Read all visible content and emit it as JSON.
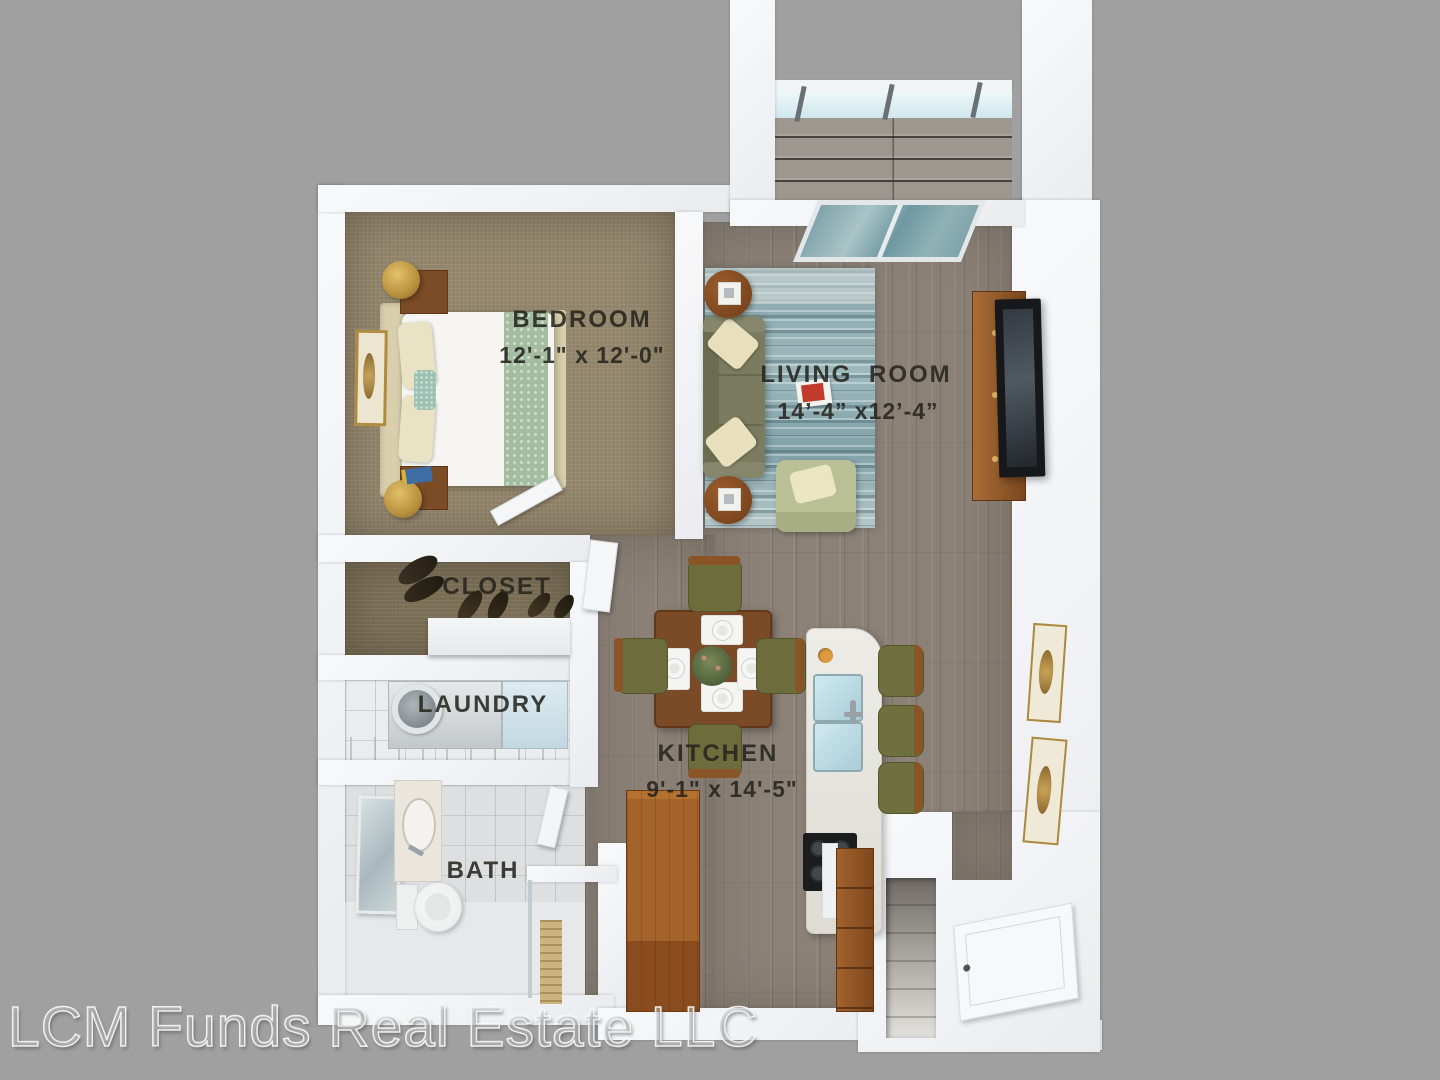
{
  "watermark": "LCM Funds Real Estate LLC",
  "rooms": {
    "bedroom": {
      "label": "BEDROOM",
      "dims": "12'-1\" x 12'-0\""
    },
    "living": {
      "label": "LIVING ROOM",
      "dims": "14’-4” x12’-4”"
    },
    "closet": {
      "label": "CLOSET"
    },
    "laundry": {
      "label": "LAUNDRY"
    },
    "kitchen": {
      "label": "KITCHEN",
      "dims": "9'-1\" x 14'-5\""
    },
    "bath": {
      "label": "BATH"
    }
  },
  "colors": {
    "background": "#a0a0a0",
    "wall": "#f2f3f5",
    "bedroom_carpet": "#94876d",
    "wood_floor": "#8b8177",
    "rug": "#86a7ad",
    "sofa": "#7b7c5f",
    "accent_wood": "#8a5526",
    "sink_glass": "#bfdfe8",
    "label_text": "#26241e"
  }
}
